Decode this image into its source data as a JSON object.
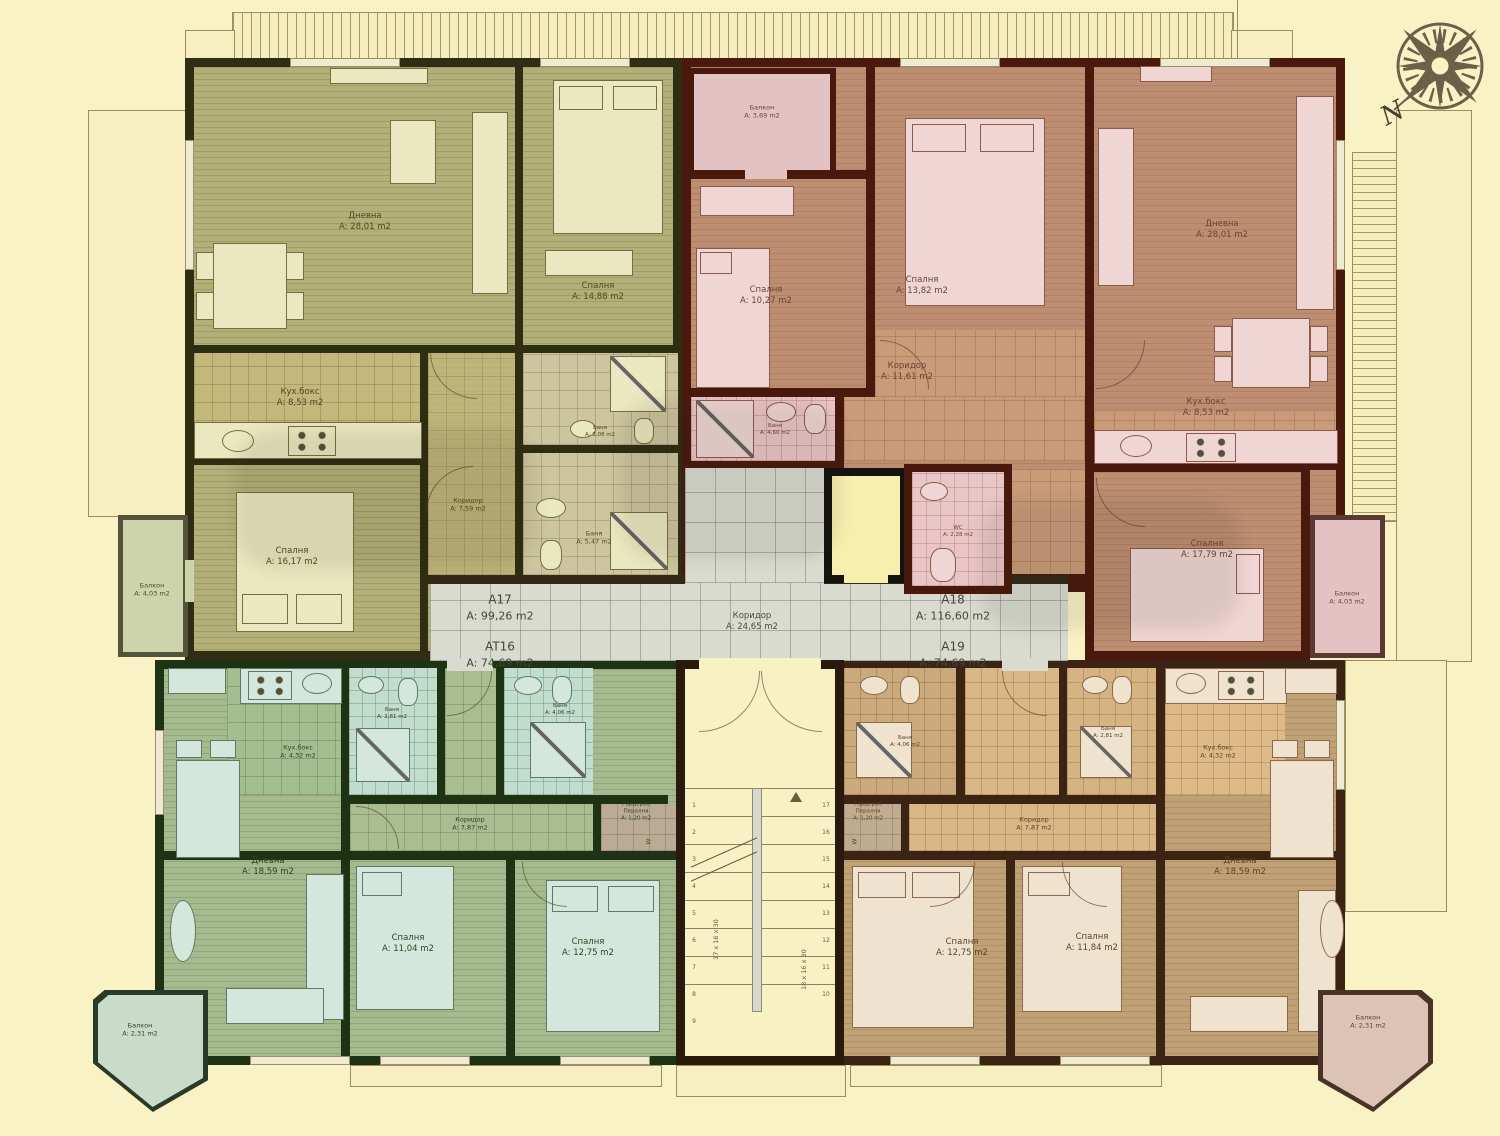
{
  "compass": {
    "north": "N"
  },
  "center": {
    "a17_id": "A17",
    "a17_area": "A: 99,26 m2",
    "at16_id": "AT16",
    "at16_area": "A: 74,69 m2",
    "a18_id": "A18",
    "a18_area": "A: 116,60 m2",
    "a19_id": "A19",
    "a19_area": "A: 74,69 m2",
    "corridor_name": "Коридор",
    "corridor_area": "A: 24,65 m2"
  },
  "stairs": {
    "flight1_dims": "17 x 16 x 30",
    "flight2_dims": "18 x 16 x 30",
    "numbers_left": "1\n2\n3\n4\n5\n6\n7\n8\n9",
    "numbers_right": "17\n16\n15\n14\n13\n12\n11\n10"
  },
  "marks": {
    "washer": "W",
    "micro": "M"
  },
  "a17_rooms": [
    {
      "name": "Дневна",
      "area": "A: 28,01 m2"
    },
    {
      "name": "Спалня",
      "area": "A: 14,88 m2"
    },
    {
      "name": "Кух.бокс",
      "area": "A: 8,53 m2"
    },
    {
      "name": "Коридор",
      "area": "A: 7,59 m2"
    },
    {
      "name": "Баня",
      "area": "A: 5,47 m2"
    },
    {
      "name": "Баня",
      "area": "A: 3,08 m2"
    },
    {
      "name": "Спалня",
      "area": "A: 16,17 m2"
    },
    {
      "name": "Балкон",
      "area": "A: 4,03 m2"
    }
  ],
  "a18_rooms": [
    {
      "name": "Балкон",
      "area": "A: 3,69 m2"
    },
    {
      "name": "Спалня",
      "area": "A: 10,27 m2"
    },
    {
      "name": "Спалня",
      "area": "A: 13,82 m2"
    },
    {
      "name": "Дневна",
      "area": "A: 28,01 m2"
    },
    {
      "name": "Кух.бокс",
      "area": "A: 8,53 m2"
    },
    {
      "name": "Коридор",
      "area": "A: 11,61 m2"
    },
    {
      "name": "Баня",
      "area": "A: 4,60 m2"
    },
    {
      "name": "Спалня",
      "area": "A: 17,79 m2"
    },
    {
      "name": "Балкон",
      "area": "A: 4,03 m2"
    },
    {
      "name": "WC",
      "area": "A: 2,28 m2"
    }
  ],
  "at16_rooms": [
    {
      "name": "Кух.бокс",
      "area": "A: 4,32 m2"
    },
    {
      "name": "Дневна",
      "area": "A: 18,59 m2"
    },
    {
      "name": "Коридор",
      "area": "A: 7,87 m2"
    },
    {
      "name": "Баня",
      "area": "A: 4,06 m2"
    },
    {
      "name": "Баня",
      "area": "A: 2,81 m2"
    },
    {
      "name": "Гардероб\nПералня",
      "area": "A: 1,20 m2"
    },
    {
      "name": "Спалня",
      "area": "A: 11,04 m2"
    },
    {
      "name": "Спалня",
      "area": "A: 12,75 m2"
    },
    {
      "name": "Балкон",
      "area": "A: 2,31 m2"
    }
  ],
  "a19_rooms": [
    {
      "name": "Баня",
      "area": "A: 4,06 m2"
    },
    {
      "name": "Баня",
      "area": "A: 2,81 m2"
    },
    {
      "name": "Кух.бокс",
      "area": "A: 4,32 m2"
    },
    {
      "name": "Гардероб\nПералня",
      "area": "A: 1,20 m2"
    },
    {
      "name": "Коридор",
      "area": "A: 7,87 m2"
    },
    {
      "name": "Спалня",
      "area": "A: 12,75 m2"
    },
    {
      "name": "Спалня",
      "area": "A: 11,84 m2"
    },
    {
      "name": "Дневна",
      "area": "A: 18,59 m2"
    },
    {
      "name": "Балкон",
      "area": "A: 2,31 m2"
    }
  ]
}
